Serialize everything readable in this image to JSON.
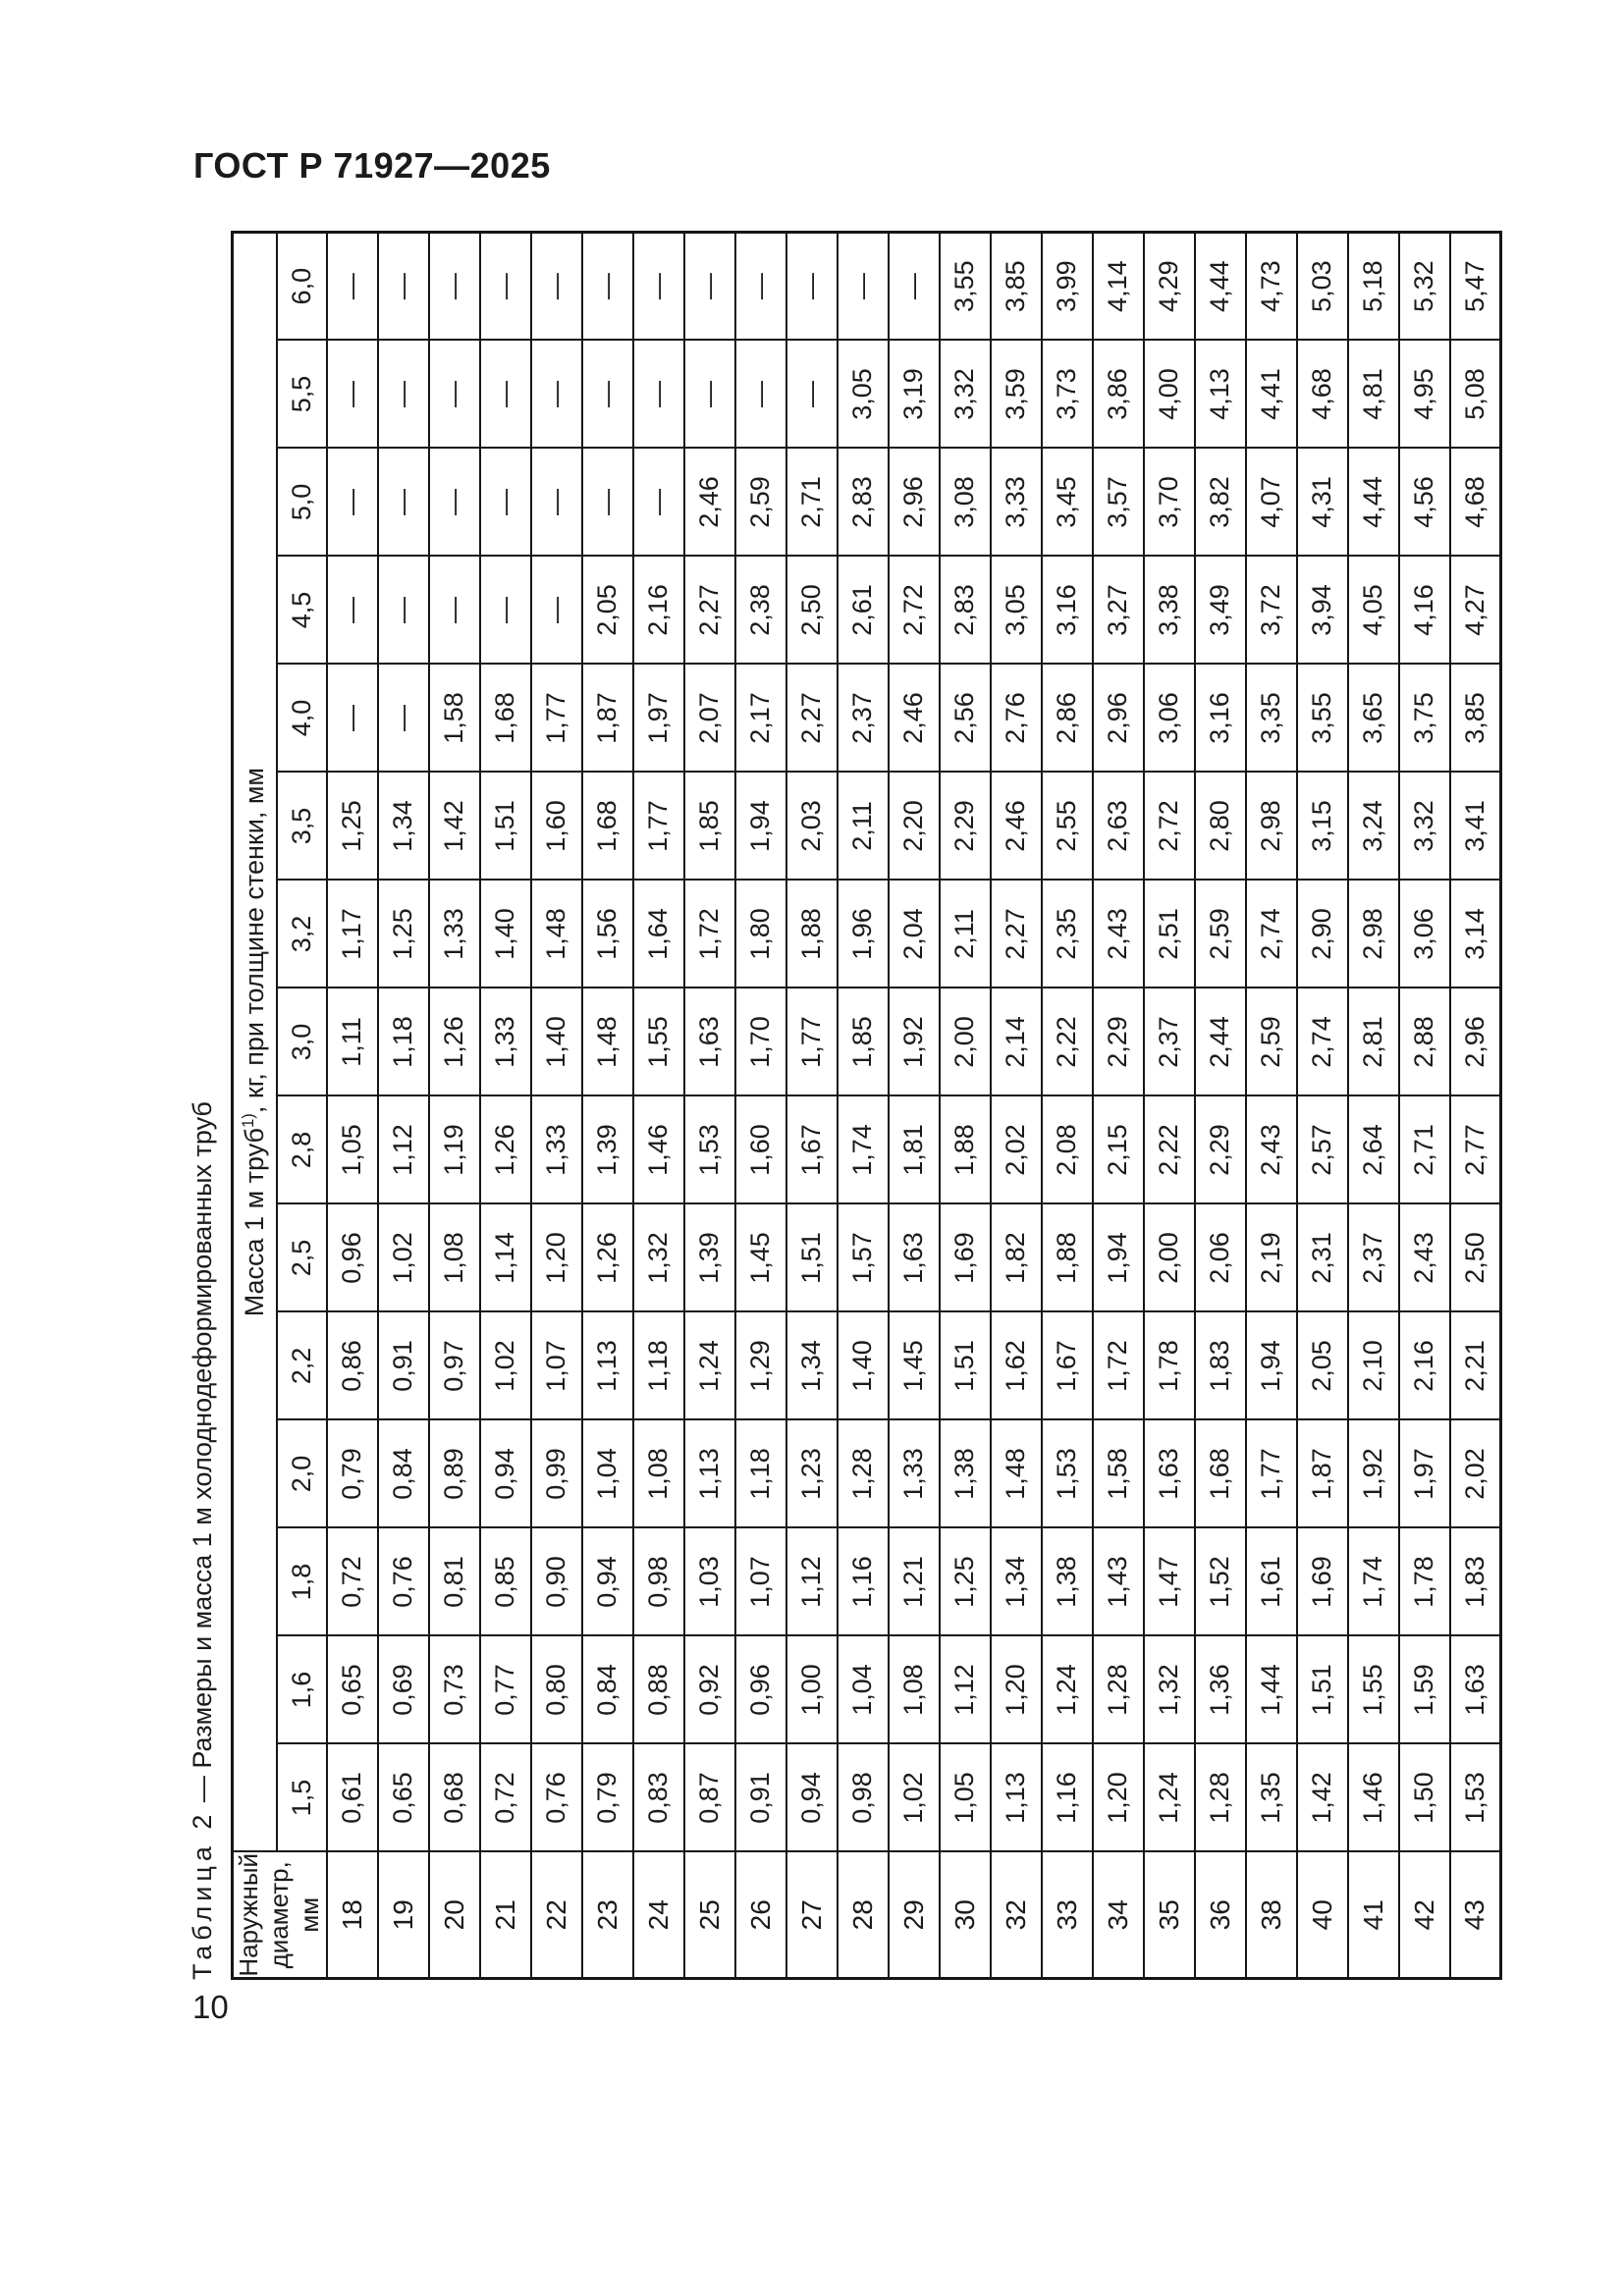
{
  "page": {
    "header": "ГОСТ Р 71927—2025",
    "number": "10"
  },
  "table": {
    "caption_label": "Таблица 2",
    "caption_text": " — Размеры и масса 1 м холоднодеформированных труб",
    "col_header_diameter_line1": "Наружный",
    "col_header_diameter_line2": "диаметр, мм",
    "col_header_mass": "Масса 1 м труб",
    "footnote_marker": "1)",
    "col_header_mass_units": ", кг, при толщине стенки, мм",
    "thicknesses": [
      "1,5",
      "1,6",
      "1,8",
      "2,0",
      "2,2",
      "2,5",
      "2,8",
      "3,0",
      "3,2",
      "3,5",
      "4,0",
      "4,5",
      "5,0",
      "5,5",
      "6,0"
    ],
    "dash": "—",
    "rows": [
      {
        "d": "18",
        "values": [
          "0,61",
          "0,65",
          "0,72",
          "0,79",
          "0,86",
          "0,96",
          "1,05",
          "1,11",
          "1,17",
          "1,25",
          "—",
          "—",
          "—",
          "—",
          "—"
        ]
      },
      {
        "d": "19",
        "values": [
          "0,65",
          "0,69",
          "0,76",
          "0,84",
          "0,91",
          "1,02",
          "1,12",
          "1,18",
          "1,25",
          "1,34",
          "—",
          "—",
          "—",
          "—",
          "—"
        ]
      },
      {
        "d": "20",
        "values": [
          "0,68",
          "0,73",
          "0,81",
          "0,89",
          "0,97",
          "1,08",
          "1,19",
          "1,26",
          "1,33",
          "1,42",
          "1,58",
          "—",
          "—",
          "—",
          "—"
        ]
      },
      {
        "d": "21",
        "values": [
          "0,72",
          "0,77",
          "0,85",
          "0,94",
          "1,02",
          "1,14",
          "1,26",
          "1,33",
          "1,40",
          "1,51",
          "1,68",
          "—",
          "—",
          "—",
          "—"
        ]
      },
      {
        "d": "22",
        "values": [
          "0,76",
          "0,80",
          "0,90",
          "0,99",
          "1,07",
          "1,20",
          "1,33",
          "1,40",
          "1,48",
          "1,60",
          "1,77",
          "—",
          "—",
          "—",
          "—"
        ]
      },
      {
        "d": "23",
        "values": [
          "0,79",
          "0,84",
          "0,94",
          "1,04",
          "1,13",
          "1,26",
          "1,39",
          "1,48",
          "1,56",
          "1,68",
          "1,87",
          "2,05",
          "—",
          "—",
          "—"
        ]
      },
      {
        "d": "24",
        "values": [
          "0,83",
          "0,88",
          "0,98",
          "1,08",
          "1,18",
          "1,32",
          "1,46",
          "1,55",
          "1,64",
          "1,77",
          "1,97",
          "2,16",
          "—",
          "—",
          "—"
        ]
      },
      {
        "d": "25",
        "values": [
          "0,87",
          "0,92",
          "1,03",
          "1,13",
          "1,24",
          "1,39",
          "1,53",
          "1,63",
          "1,72",
          "1,85",
          "2,07",
          "2,27",
          "2,46",
          "—",
          "—"
        ]
      },
      {
        "d": "26",
        "values": [
          "0,91",
          "0,96",
          "1,07",
          "1,18",
          "1,29",
          "1,45",
          "1,60",
          "1,70",
          "1,80",
          "1,94",
          "2,17",
          "2,38",
          "2,59",
          "—",
          "—"
        ]
      },
      {
        "d": "27",
        "values": [
          "0,94",
          "1,00",
          "1,12",
          "1,23",
          "1,34",
          "1,51",
          "1,67",
          "1,77",
          "1,88",
          "2,03",
          "2,27",
          "2,50",
          "2,71",
          "—",
          "—"
        ]
      },
      {
        "d": "28",
        "values": [
          "0,98",
          "1,04",
          "1,16",
          "1,28",
          "1,40",
          "1,57",
          "1,74",
          "1,85",
          "1,96",
          "2,11",
          "2,37",
          "2,61",
          "2,83",
          "3,05",
          "—"
        ]
      },
      {
        "d": "29",
        "values": [
          "1,02",
          "1,08",
          "1,21",
          "1,33",
          "1,45",
          "1,63",
          "1,81",
          "1,92",
          "2,04",
          "2,20",
          "2,46",
          "2,72",
          "2,96",
          "3,19",
          "—"
        ]
      },
      {
        "d": "30",
        "values": [
          "1,05",
          "1,12",
          "1,25",
          "1,38",
          "1,51",
          "1,69",
          "1,88",
          "2,00",
          "2,11",
          "2,29",
          "2,56",
          "2,83",
          "3,08",
          "3,32",
          "3,55"
        ]
      },
      {
        "d": "32",
        "values": [
          "1,13",
          "1,20",
          "1,34",
          "1,48",
          "1,62",
          "1,82",
          "2,02",
          "2,14",
          "2,27",
          "2,46",
          "2,76",
          "3,05",
          "3,33",
          "3,59",
          "3,85"
        ]
      },
      {
        "d": "33",
        "values": [
          "1,16",
          "1,24",
          "1,38",
          "1,53",
          "1,67",
          "1,88",
          "2,08",
          "2,22",
          "2,35",
          "2,55",
          "2,86",
          "3,16",
          "3,45",
          "3,73",
          "3,99"
        ]
      },
      {
        "d": "34",
        "values": [
          "1,20",
          "1,28",
          "1,43",
          "1,58",
          "1,72",
          "1,94",
          "2,15",
          "2,29",
          "2,43",
          "2,63",
          "2,96",
          "3,27",
          "3,57",
          "3,86",
          "4,14"
        ]
      },
      {
        "d": "35",
        "values": [
          "1,24",
          "1,32",
          "1,47",
          "1,63",
          "1,78",
          "2,00",
          "2,22",
          "2,37",
          "2,51",
          "2,72",
          "3,06",
          "3,38",
          "3,70",
          "4,00",
          "4,29"
        ]
      },
      {
        "d": "36",
        "values": [
          "1,28",
          "1,36",
          "1,52",
          "1,68",
          "1,83",
          "2,06",
          "2,29",
          "2,44",
          "2,59",
          "2,80",
          "3,16",
          "3,49",
          "3,82",
          "4,13",
          "4,44"
        ]
      },
      {
        "d": "38",
        "values": [
          "1,35",
          "1,44",
          "1,61",
          "1,77",
          "1,94",
          "2,19",
          "2,43",
          "2,59",
          "2,74",
          "2,98",
          "3,35",
          "3,72",
          "4,07",
          "4,41",
          "4,73"
        ]
      },
      {
        "d": "40",
        "values": [
          "1,42",
          "1,51",
          "1,69",
          "1,87",
          "2,05",
          "2,31",
          "2,57",
          "2,74",
          "2,90",
          "3,15",
          "3,55",
          "3,94",
          "4,31",
          "4,68",
          "5,03"
        ]
      },
      {
        "d": "41",
        "values": [
          "1,46",
          "1,55",
          "1,74",
          "1,92",
          "2,10",
          "2,37",
          "2,64",
          "2,81",
          "2,98",
          "3,24",
          "3,65",
          "4,05",
          "4,44",
          "4,81",
          "5,18"
        ]
      },
      {
        "d": "42",
        "values": [
          "1,50",
          "1,59",
          "1,78",
          "1,97",
          "2,16",
          "2,43",
          "2,71",
          "2,88",
          "3,06",
          "3,32",
          "3,75",
          "4,16",
          "4,56",
          "4,95",
          "5,32"
        ]
      },
      {
        "d": "43",
        "values": [
          "1,53",
          "1,63",
          "1,83",
          "2,02",
          "2,21",
          "2,50",
          "2,77",
          "2,96",
          "3,14",
          "3,41",
          "3,85",
          "4,27",
          "4,68",
          "5,08",
          "5,47"
        ]
      }
    ]
  }
}
